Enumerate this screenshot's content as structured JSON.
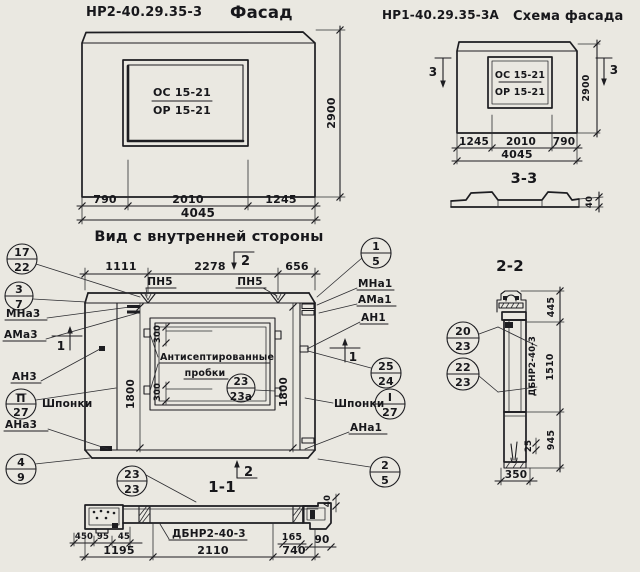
{
  "colors": {
    "paper": "#eae8e1",
    "ink": "#1d1d21"
  },
  "facade_left": {
    "code": "НР2-40.29.35-3",
    "title": "Фасад",
    "win_top": "ОС 15-21",
    "win_bot": "ОР 15-21",
    "dim_left": "790",
    "dim_mid": "2010",
    "dim_right": "1245",
    "dim_total": "4045",
    "dim_height": "2900"
  },
  "facade_right": {
    "code": "НР1-40.29.35-3А",
    "title": "Схема фасада",
    "win_top": "ОС 15-21",
    "win_bot": "ОР 15-21",
    "dim_left": "1245",
    "dim_mid": "2010",
    "dim_right": "790",
    "dim_total": "4045",
    "dim_height": "2900",
    "marker_left": "3",
    "marker_right": "3"
  },
  "section33": {
    "label": "3-3",
    "dim": "40"
  },
  "inner": {
    "title": "Вид с внутренней стороны",
    "dim1": "1111",
    "dim2": "2278",
    "dim3": "656",
    "pn1": "ПН5",
    "pn2": "ПН5",
    "marker_top": "2",
    "marker_bottom": "2",
    "marker_left": "1",
    "marker_right": "1",
    "side_left": "1800",
    "side_right": "1800",
    "plug_top": "300",
    "plug_bot": "300",
    "note1": "Антисептированные",
    "note2": "пробки",
    "win_call_n": "23",
    "win_call_d": "23а",
    "L": {
      "c17": "17",
      "c22": "22",
      "c3": "3",
      "c7": "7",
      "mna": "МНа3",
      "ama": "АМа3",
      "an": "АН3",
      "keys": "Шпонки",
      "cp": "П",
      "cp27": "27",
      "ana": "АНа3",
      "c4": "4",
      "c9": "9"
    },
    "R": {
      "c1": "1",
      "c5": "5",
      "mna": "МНа1",
      "ama": "АМа1",
      "an": "АН1",
      "c25": "25",
      "c24": "24",
      "keys": "Шпонки",
      "ci": "I",
      "ci27": "27",
      "ana": "АНа1",
      "c2": "2",
      "c5b": "5"
    }
  },
  "section11": {
    "label": "1-1",
    "cn": "23",
    "cd": "23",
    "part": "ДБНР2-40-3",
    "d450": "450",
    "d95": "95",
    "d45": "45",
    "d165": "165",
    "d90": "90",
    "d40": "40",
    "d1195": "1195",
    "d2110": "2110",
    "d740": "740"
  },
  "section22": {
    "label": "2-2",
    "cn1": "20",
    "cd1": "23",
    "cn2": "22",
    "cd2": "23",
    "part": "ДБНР2-40-3",
    "d445": "445",
    "d1510": "1510",
    "d945": "945",
    "d25": "25",
    "d350": "350"
  }
}
